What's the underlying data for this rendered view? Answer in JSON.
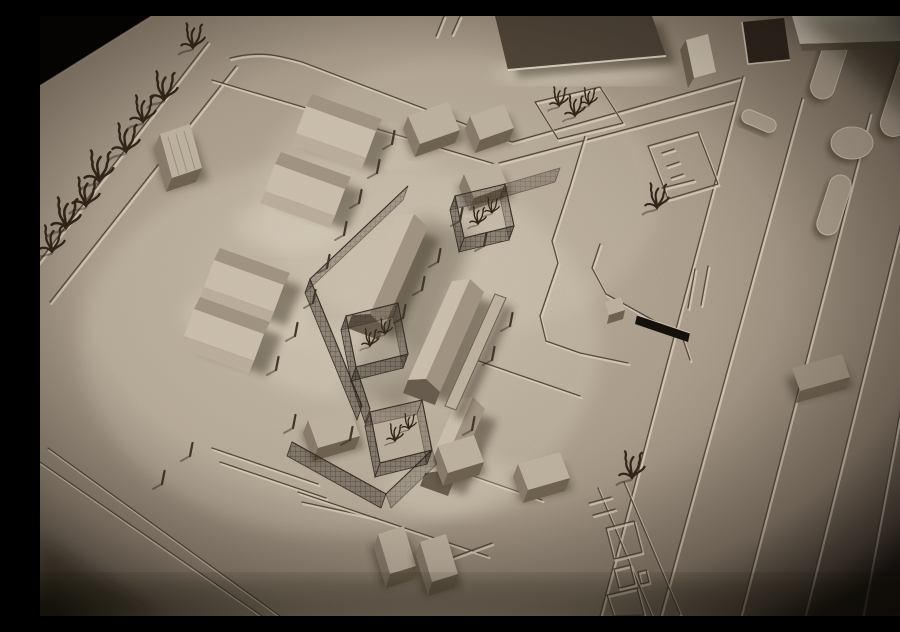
{
  "meta": {
    "image_kind": "photograph",
    "subject": "monochrome sepia architectural scale model of an urban site, oblique aerial view",
    "lighting": "warm spotlight from the lower left with bright halos around buildings and a heavy dark vignette in the corners",
    "visible_text": "none"
  },
  "palette": {
    "bgLight": "#cabca9",
    "bgMid": "#b2a492",
    "bgDark": "#8d7f6f",
    "bgEdge": "#453b30",
    "lineLo": "#5a4d40",
    "lineHi": "#e3d7c3",
    "roofLight": "#c6b9a6",
    "sideWall": "#8f8171",
    "frontWall": "#746754",
    "slopeBright": "#d4c7b4",
    "slopeDark": "#a99b89",
    "gableEnd": "#6e6152",
    "sideLit": "#c4b6a3",
    "slabDark": "#52473a",
    "slabLight": "#e2d7c4",
    "towerLight": "#d5c9b6",
    "pitDark": "#31281f",
    "islandFill": "#b4a694",
    "islandEdge": "#d6c9b5",
    "meshRail": "#3c332a",
    "postBrown": "#453a2d",
    "treeBrown": "#36281b",
    "glow": "#f3ead8",
    "benchDark": "#16110c",
    "shadow": "#2e2519"
  },
  "scene": {
    "elements": [
      {
        "name": "baseboard",
        "kind": "ground plane",
        "location": "full frame, warm grey card"
      },
      {
        "name": "left-road",
        "kind": "engraved road",
        "location": "upper left, running to lower left edge"
      },
      {
        "name": "street-trees",
        "kind": "wire trees x8",
        "location": "along left road"
      },
      {
        "name": "road-block",
        "kind": "flat-roof building",
        "location": "on left road"
      },
      {
        "name": "gabled-barns",
        "kind": "pitched-roof bars x4",
        "location": "left of centre"
      },
      {
        "name": "long-gabled-buildings",
        "kind": "pitched-roof bars x3",
        "location": "centre, en echelon"
      },
      {
        "name": "mesh-courtyards",
        "kind": "wire-mesh enclosures with trees x3",
        "location": "centre complex"
      },
      {
        "name": "mesh-fences",
        "kind": "wire-mesh fence runs",
        "location": "around centre complex"
      },
      {
        "name": "bollard-posts",
        "kind": "small posts x20",
        "location": "scattered through complex"
      },
      {
        "name": "flat-blocks",
        "kind": "small flat-roof blocks x9",
        "location": "around complex and bottom centre"
      },
      {
        "name": "avenue",
        "kind": "multi-lane engraved avenue",
        "location": "right half, diagonal"
      },
      {
        "name": "median-islands",
        "kind": "raised pill islands and circle",
        "location": "upper right"
      },
      {
        "name": "bus-stop",
        "kind": "dark bench and kiosk block",
        "location": "centre right"
      },
      {
        "name": "parking-markings",
        "kind": "engraved squares strip",
        "location": "lower right"
      },
      {
        "name": "top-edge-buildings",
        "kind": "dark slab, tower, white slabs, sunken pit",
        "location": "top edge"
      },
      {
        "name": "tree-plaza",
        "kind": "small plaza with trees",
        "location": "top centre-right"
      },
      {
        "name": "vignette",
        "kind": "dark photographic vignette",
        "location": "all corners, black top-left corner"
      }
    ]
  }
}
